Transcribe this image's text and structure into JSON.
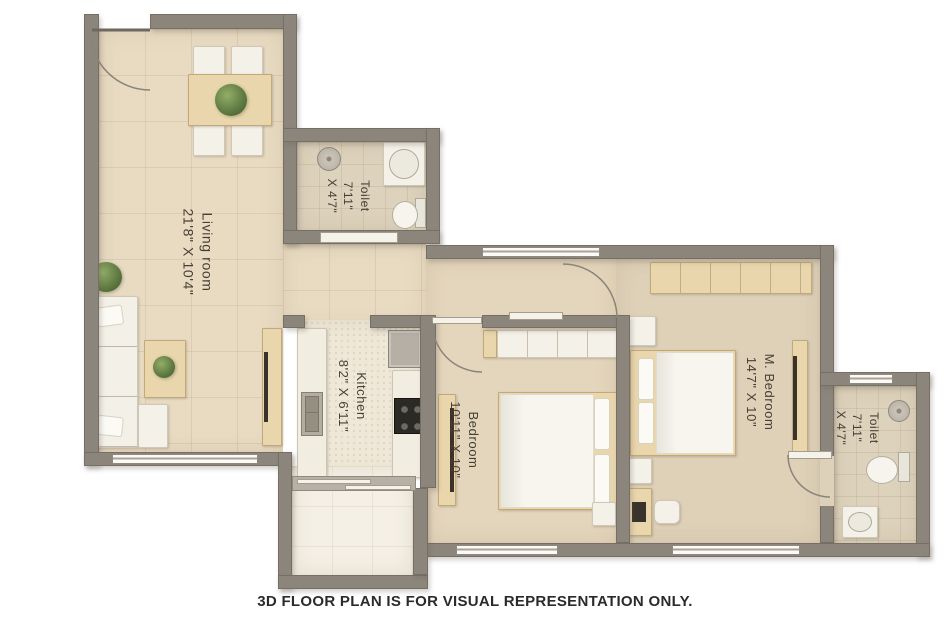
{
  "caption": "3D FLOOR PLAN IS FOR VISUAL REPRESENTATION ONLY.",
  "rooms": [
    {
      "id": "living-room",
      "lines": [
        "Living room",
        "21'8\" X 10'4\""
      ]
    },
    {
      "id": "toilet-top",
      "lines": [
        "Toilet",
        "7'11\"",
        "X 4'7\""
      ]
    },
    {
      "id": "kitchen",
      "lines": [
        "Kitchen",
        "8'2\" X 6'11\""
      ]
    },
    {
      "id": "bedroom",
      "lines": [
        "Bedroom",
        "10'11\" X 10\""
      ]
    },
    {
      "id": "m-bedroom",
      "lines": [
        "M. Bedroom",
        "14'7\" X 10\""
      ]
    },
    {
      "id": "toilet-right",
      "lines": [
        "Toilet",
        "7'11\"",
        "X 4'7\""
      ]
    }
  ],
  "fixtures": [
    "entry-door-swing",
    "dining-table",
    "dining-chairs",
    "indoor-plants",
    "l-shaped-sofa",
    "coffee-table",
    "tv-units",
    "wash-basins",
    "toilet-bowls",
    "shower-heads",
    "kitchen-sink",
    "stove",
    "fridge",
    "wardrobes",
    "double-beds",
    "nightstands",
    "study-desk",
    "stool",
    "windows",
    "balcony"
  ],
  "colors": {
    "wall": "#8c857b",
    "floor_living": "#e8dbc2",
    "floor_toilet": "#ddd2bc",
    "floor_kitchen": "#efe8d8",
    "floor_bedroom": "#e4d6bc",
    "floor_m_bedroom": "#ded1b8",
    "floor_balcony": "#f4f0e5",
    "wood": "#e9d6ac",
    "furniture_white": "#f4f1e8",
    "plant_green": "#55703a",
    "label_text": "#453f35",
    "caption_text": "#2b2b2b"
  }
}
